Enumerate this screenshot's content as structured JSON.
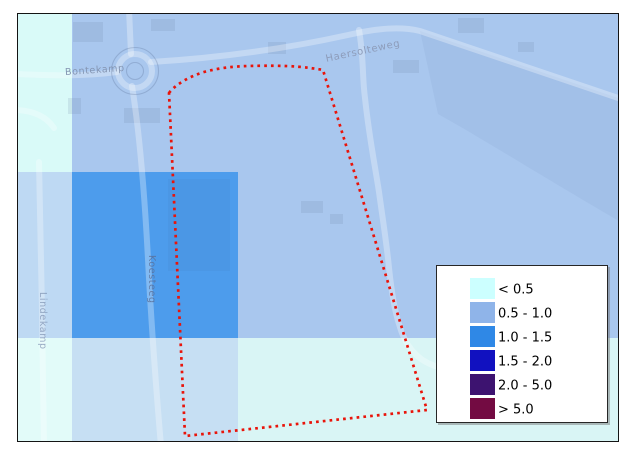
{
  "map": {
    "street_labels": {
      "bontekamp": "Bontekamp",
      "haersolteweg": "Haersolteweg",
      "koesteeg": "Koesteeg",
      "lindekamp": "Lindekamp"
    },
    "overlay_regions": {
      "base_depth_0_5_1_0": {
        "depth_class": "0.5 - 1.0",
        "color": "#a9c7ee"
      },
      "left_strip_top_lt_0_5": {
        "depth_class": "< 0.5",
        "color": "#d9faf8"
      },
      "left_strip_mid": {
        "depth_class": "< 0.5 over 0.5 - 1.0",
        "color": "#bed9f3"
      },
      "left_strip_bottom": {
        "depth_class": "< 0.5",
        "color": "#e2fbf9"
      },
      "center_square_1_0_1_5": {
        "depth_class": "1.0 - 1.5",
        "color": "#4d9cec"
      },
      "bottom_strip_mid": {
        "depth_class": "< 0.5 over 1.0 - 1.5",
        "color": "#c6dff3"
      },
      "bottom_strip_right": {
        "depth_class": "< 0.5",
        "color": "#d9f5f5"
      }
    },
    "study_area_outline": {
      "color": "#e9140a",
      "style": "dotted"
    }
  },
  "legend": {
    "items": [
      {
        "label": "< 0.5",
        "color": "#ccffff"
      },
      {
        "label": "0.5 - 1.0",
        "color": "#8fb4e9"
      },
      {
        "label": "1.0 - 1.5",
        "color": "#2f88e6"
      },
      {
        "label": "1.5 - 2.0",
        "color": "#1111c0"
      },
      {
        "label": "2.0 - 5.0",
        "color": "#3d1370"
      },
      {
        "label": "> 5.0",
        "color": "#730b42"
      }
    ]
  }
}
